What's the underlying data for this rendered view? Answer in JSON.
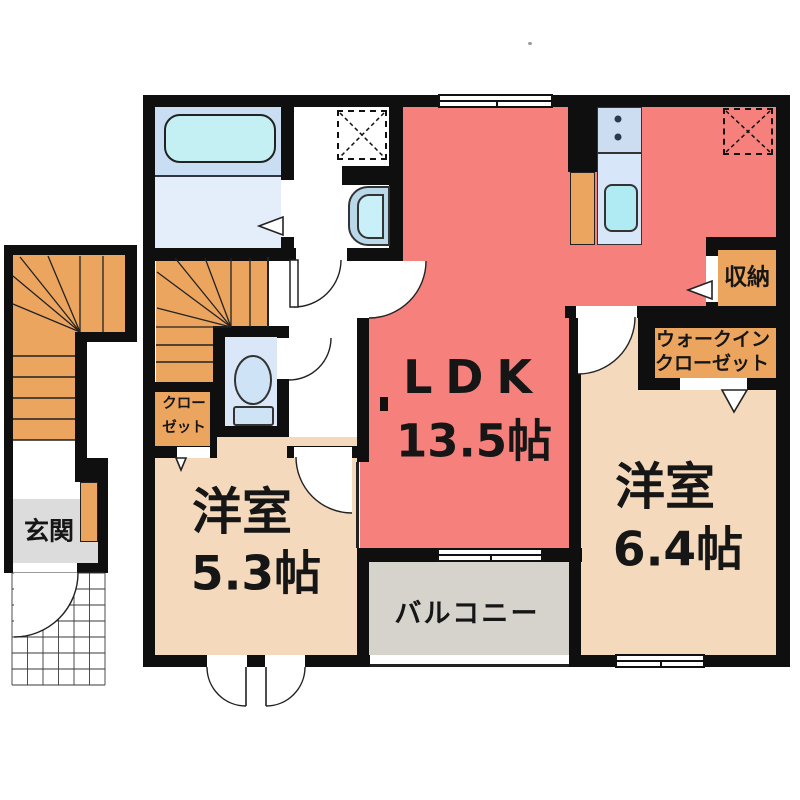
{
  "plan": {
    "type": "apartment-floor-plan",
    "rooms": {
      "ldk": {
        "label": "LDK",
        "area": "13.5帖"
      },
      "western_room_5_3": {
        "label": "洋室",
        "area": "5.3帖"
      },
      "western_room_6_4": {
        "label": "洋室",
        "area": "6.4帖"
      },
      "balcony": {
        "label": "バルコニー"
      },
      "entrance": {
        "label": "玄関"
      },
      "storage": {
        "label": "収納"
      },
      "walk_in_closet": {
        "label_line1": "ウォークイン",
        "label_line2": "クローゼット"
      },
      "closet": {
        "label_line1": "クロー",
        "label_line2": "ゼット"
      }
    },
    "colors": {
      "wall": "#0f0f0f",
      "ldk_red": "#f5807c",
      "western_room_tan": "#f4d9bc",
      "stairs_closet_orange": "#eca55e",
      "balcony_gray": "#d6d2cc",
      "entrance_gray": "#dcdcdc",
      "bath_blue": "#c9def3",
      "bath_floor_blue": "#e3eefa",
      "tub_cyan": "#c4eff3",
      "fixture_blue": "#cfe3f6",
      "toilet_floor": "#d9e7f8",
      "counter_blue": "#ccddf1",
      "sink_cyan": "#b0ebf4"
    }
  }
}
